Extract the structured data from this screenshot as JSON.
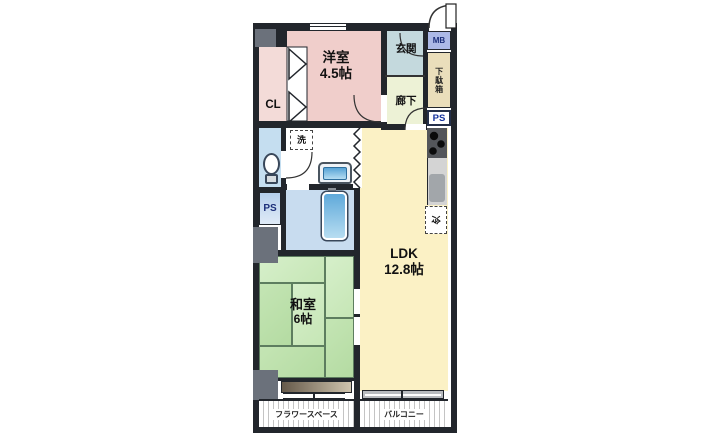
{
  "rooms": {
    "western_room": {
      "name": "洋室",
      "size": "4.5帖"
    },
    "closet": {
      "name": "CL"
    },
    "entrance": {
      "name": "玄関"
    },
    "hallway": {
      "name": "廊下"
    },
    "ldk": {
      "name": "LDK",
      "size": "12.8帖"
    },
    "japanese_room": {
      "name": "和室",
      "size": "6帖"
    }
  },
  "fixtures": {
    "meter_box": "MB",
    "shoe_cabinet": "下駄箱",
    "pipe_space_right": "PS",
    "pipe_space_left": "PS",
    "washing_machine": "洗",
    "refrigerator": "冷"
  },
  "outdoor": {
    "flower_space": "フラワースペース",
    "balcony": "バルコニー"
  },
  "colors": {
    "wall": "#22262c",
    "western_room": "#f0cecb",
    "closet": "#f3dbd8",
    "entrance": "#c4d9dd",
    "hallway": "#edf2d6",
    "ldk": "#fbf1c5",
    "tatami_light": "#cdeabf",
    "tatami_dark": "#bee1ad",
    "bathroom": "#c8dcef",
    "toilet_room": "#c5def0",
    "meter_box": "#acb9e6",
    "shoe_cabinet": "#eadebb",
    "pillar": "#6b717b",
    "bathtub": "#5fa9da"
  }
}
